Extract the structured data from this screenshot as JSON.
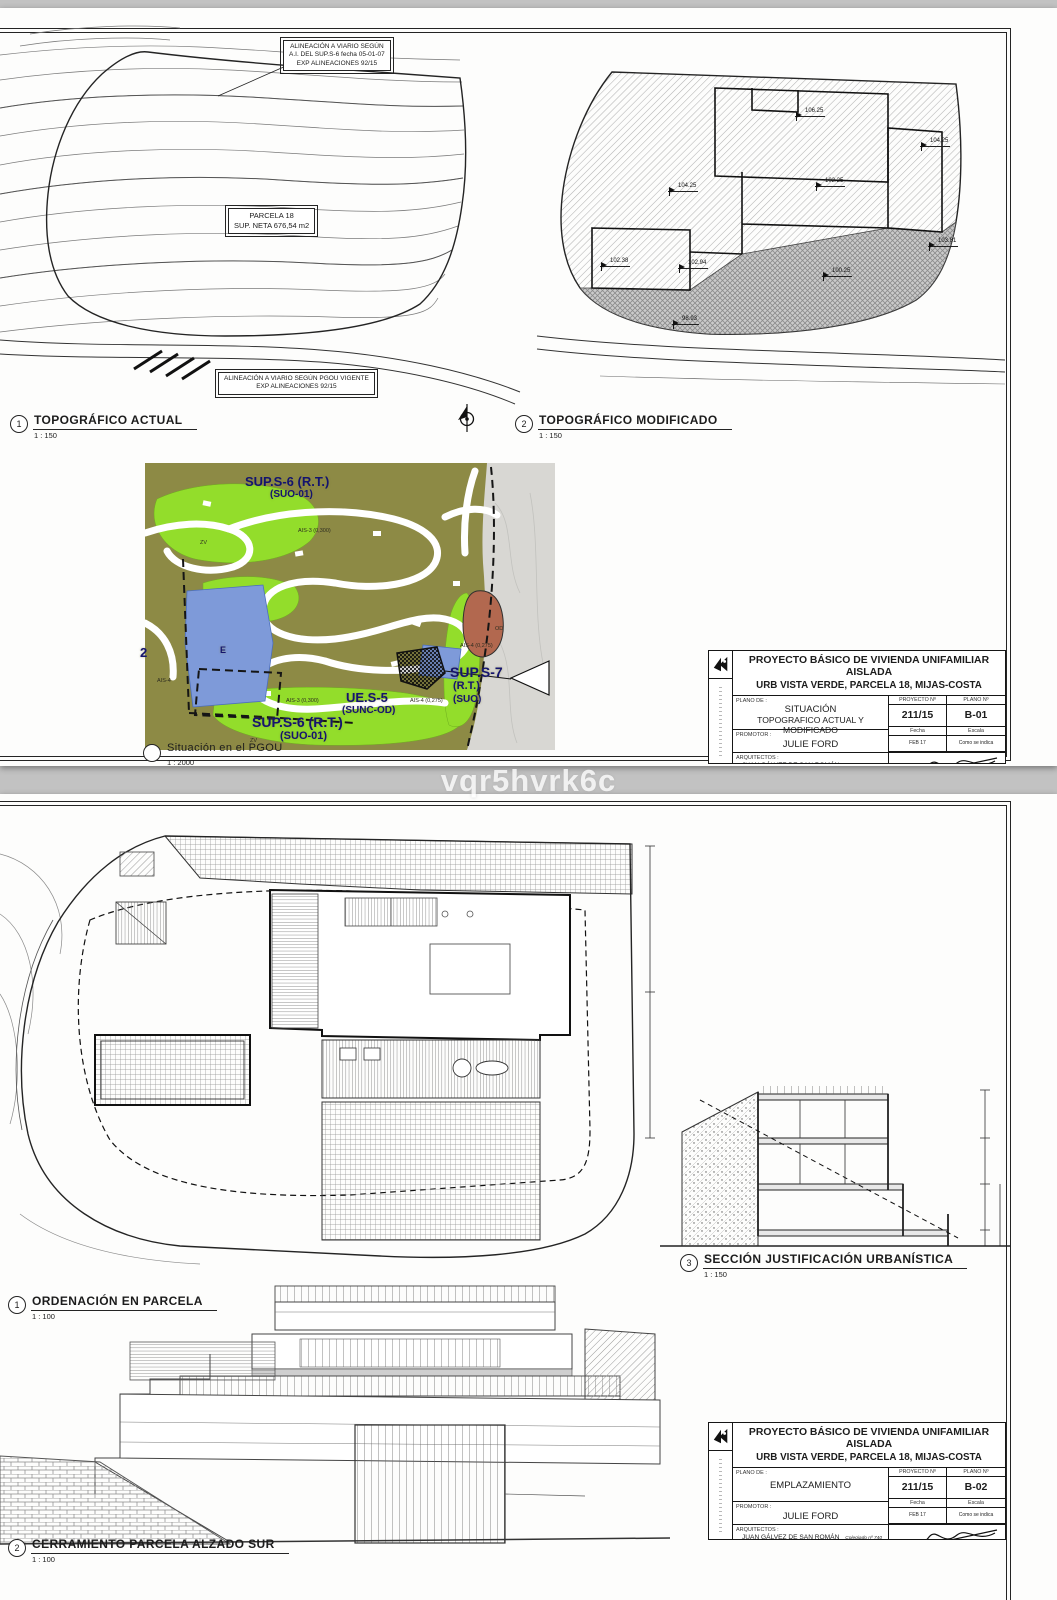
{
  "watermark": "vqr5hvrk6c",
  "sheet1": {
    "annotations": {
      "align_top_l1": "ALINEACIÓN A VIARIO SEGÚN",
      "align_top_l2": "A.I. DEL SUP.S-6 fecha 05-01-07",
      "align_top_l3": "EXP ALINEACIONES 92/15",
      "parcel_l1": "PARCELA 18",
      "parcel_l2": "SUP. NETA 676,54 m2",
      "align_bottom_l1": "ALINEACIÓN A VIARIO SEGÚN PGOU VIGENTE",
      "align_bottom_l2": "EXP ALINEACIONES 92/15"
    },
    "view1": {
      "num": "1",
      "title": "TOPOGRÁFICO ACTUAL",
      "scale": "1 : 150"
    },
    "view2": {
      "num": "2",
      "title": "TOPOGRÁFICO MODIFICADO",
      "scale": "1 : 150"
    },
    "view_pgou": {
      "num": "",
      "title": "Situación en el PGOU",
      "scale": "1 : 2000"
    },
    "spot_elevations": {
      "s1": "106.25",
      "s2": "104.25",
      "s3": "104.25",
      "s4": "102.25",
      "s5": "103.81",
      "s6": "102.38",
      "s7": "102.94",
      "s8": "100.25",
      "s9": "98.93"
    },
    "pgou_map": {
      "sups6_top": "SUP.S-6 (R.T.)",
      "suo01_top": "(SUO-01)",
      "ues5": "UE.S-5",
      "suncod": "(SUNC-OD)",
      "sups7": "SUP.S-7",
      "rt": "(R.T.)",
      "suo": "(SUO)",
      "sups6_bot": "SUP.S-6 (R.T.)",
      "suo01_bot": "(SUO-01)",
      "zone_e": "E",
      "zone_od": "OD",
      "zone_zv1": "ZV",
      "zone_zv2": "ZV",
      "zone_ais3a": "AIS-3 (0,300)",
      "zone_ais3b": "AIS-3 (0,300)",
      "zone_ais4a": "AIS-4 (0,275)",
      "zone_ais4b": "AIS-4 (0,275)",
      "zone_ais4c": "AIS-4",
      "zone_2": "2"
    },
    "titleblock": {
      "title_l1": "PROYECTO BÁSICO DE VIVIENDA UNIFAMILIAR AISLADA",
      "title_l2": "URB VISTA VERDE, PARCELA 18, MIJAS-COSTA",
      "plano_de_label": "PLANO DE :",
      "plano_l1": "SITUACIÓN",
      "plano_l2": "TOPOGRAFICO ACTUAL Y MODIFICADO",
      "proyecto_label": "PROYECTO Nº",
      "proyecto": "211/15",
      "plano_num_label": "PLANO Nº",
      "plano_num": "B-01",
      "fecha_label": "Fecha",
      "fecha": "FEB 17",
      "escala_label": "Escala",
      "escala": "Como se indica",
      "promotor_label": "PROMOTOR :",
      "promotor": "JULIE FORD",
      "arquitectos_label": "ARQUITECTOS :",
      "arq1": "JUAN GÁLVEZ DE SAN ROMÁN",
      "arq1_col": "Colegiado nº 740",
      "arq2": "MARIANO SÁNCHEZ MARFIL",
      "arq2_col": "Colegiado nº 869"
    },
    "colors": {
      "pgou_bg": "#8d8a45",
      "pgou_green": "#93dd2b",
      "pgou_blue": "#7e9ad9",
      "pgou_red": "#b2684f"
    }
  },
  "sheet2": {
    "view1": {
      "num": "1",
      "title": "ORDENACIÓN EN PARCELA",
      "scale": "1 : 100"
    },
    "view3": {
      "num": "3",
      "title": "SECCIÓN JUSTIFICACIÓN URBANÍSTICA",
      "scale": "1 : 150"
    },
    "view2": {
      "num": "2",
      "title": "CERRAMIENTO PARCELA ALZADO SUR",
      "scale": "1 : 100"
    },
    "titleblock": {
      "title_l1": "PROYECTO BÁSICO DE VIVIENDA UNIFAMILIAR AISLADA",
      "title_l2": "URB VISTA VERDE, PARCELA 18, MIJAS-COSTA",
      "plano_de_label": "PLANO DE :",
      "plano_l1": "EMPLAZAMIENTO",
      "plano_l2": "",
      "proyecto_label": "PROYECTO Nº",
      "proyecto": "211/15",
      "plano_num_label": "PLANO Nº",
      "plano_num": "B-02",
      "fecha_label": "Fecha",
      "fecha": "FEB 17",
      "escala_label": "Escala",
      "escala": "Como se indica",
      "promotor_label": "PROMOTOR :",
      "promotor": "JULIE FORD",
      "arquitectos_label": "ARQUITECTOS :",
      "arq1": "JUAN GÁLVEZ DE SAN ROMÁN",
      "arq1_col": "Colegiado nº 740",
      "arq2": "MARIANO SÁNCHEZ MARFIL",
      "arq2_col": "Colegiado nº 869"
    }
  }
}
